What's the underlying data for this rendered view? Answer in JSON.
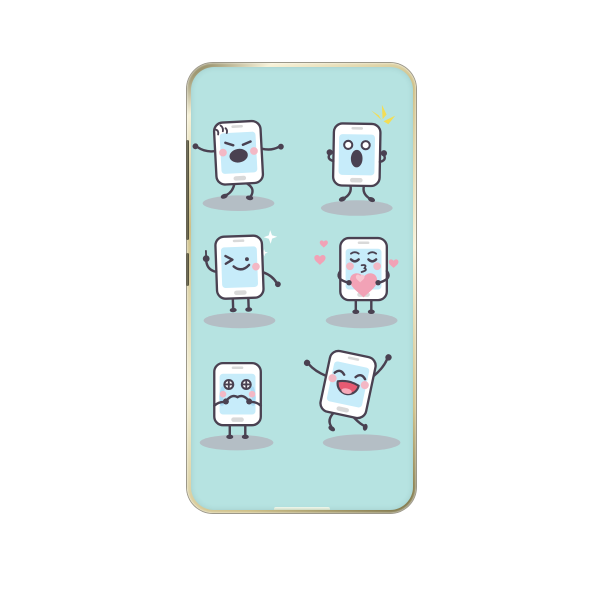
{
  "page": {
    "background_color": "#ffffff",
    "description": "Product photo of a smartphone back case with cartoon phone emoji artwork"
  },
  "case": {
    "back_color": "#b6e3e1",
    "frame_light": "#f7f2d8",
    "frame_mid": "#cfc189",
    "frame_dark": "#7a7247",
    "button_color": "#4a4733",
    "side_buttons": [
      {
        "label": "volume button"
      },
      {
        "label": "power button"
      }
    ]
  },
  "artwork": {
    "style": "cute cartoon smartphone characters in 2x3 grid",
    "outline_color": "#4a4151",
    "body_color": "#ffffff",
    "screen_color": "#c7ecfa",
    "hardware_gray": "#d9d9d9",
    "cheek_color": "#f3b8c5",
    "shadow_color": "#b4b7bf",
    "sparkle_white": "#ffffff",
    "accent_yellow": "#f3dd55",
    "heart_pink": "#f2a2b6",
    "heart_light": "#f8c6d1",
    "tear_blue": "#aadcf5",
    "mouth_red": "#e65a72",
    "tongue_pink": "#f6a9ba",
    "characters": [
      {
        "emotion": "angry phone with anger mark, shouting mouth, arms out walking",
        "position": "top-left"
      },
      {
        "emotion": "surprised phone with round eyes, open mouth and yellow flash",
        "position": "top-right"
      },
      {
        "emotion": "winking phone giving thumbs up with white sparkles",
        "position": "middle-left"
      },
      {
        "emotion": "kissing phone holding a big pink heart with floating hearts",
        "position": "middle-right"
      },
      {
        "emotion": "crying phone with blue tears and hands at mouth",
        "position": "bottom-left"
      },
      {
        "emotion": "happy dancing phone with big laughing mouth",
        "position": "bottom-right"
      }
    ]
  }
}
